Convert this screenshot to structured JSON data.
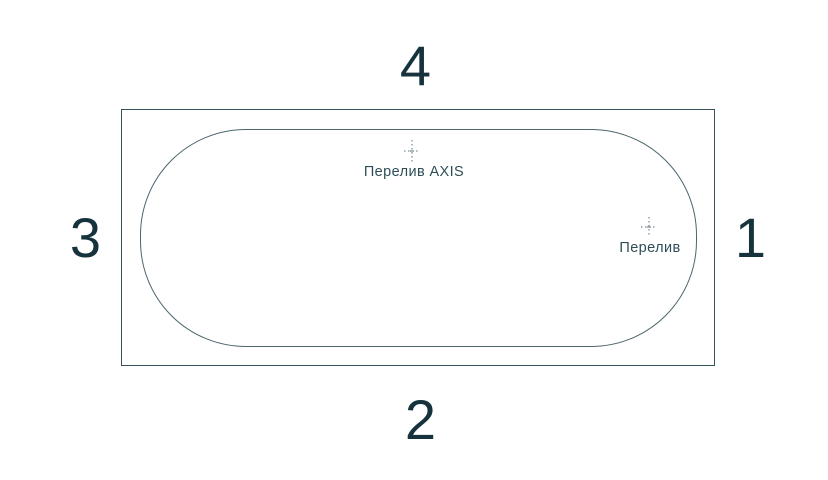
{
  "diagram": {
    "kind": "bathtub-top-view",
    "sides": {
      "top": "4",
      "bottom": "2",
      "left": "3",
      "right": "1"
    },
    "markers": {
      "overflow_axis": {
        "label": "Перелив AXIS"
      },
      "overflow": {
        "label": "Перелив"
      }
    },
    "colors": {
      "background": "#ffffff",
      "outer_outline": "#37525a",
      "tub_outline": "#4d666e",
      "number_text": "#16333d",
      "label_text": "#2e4e57",
      "center_mark": "#5a7078"
    }
  }
}
